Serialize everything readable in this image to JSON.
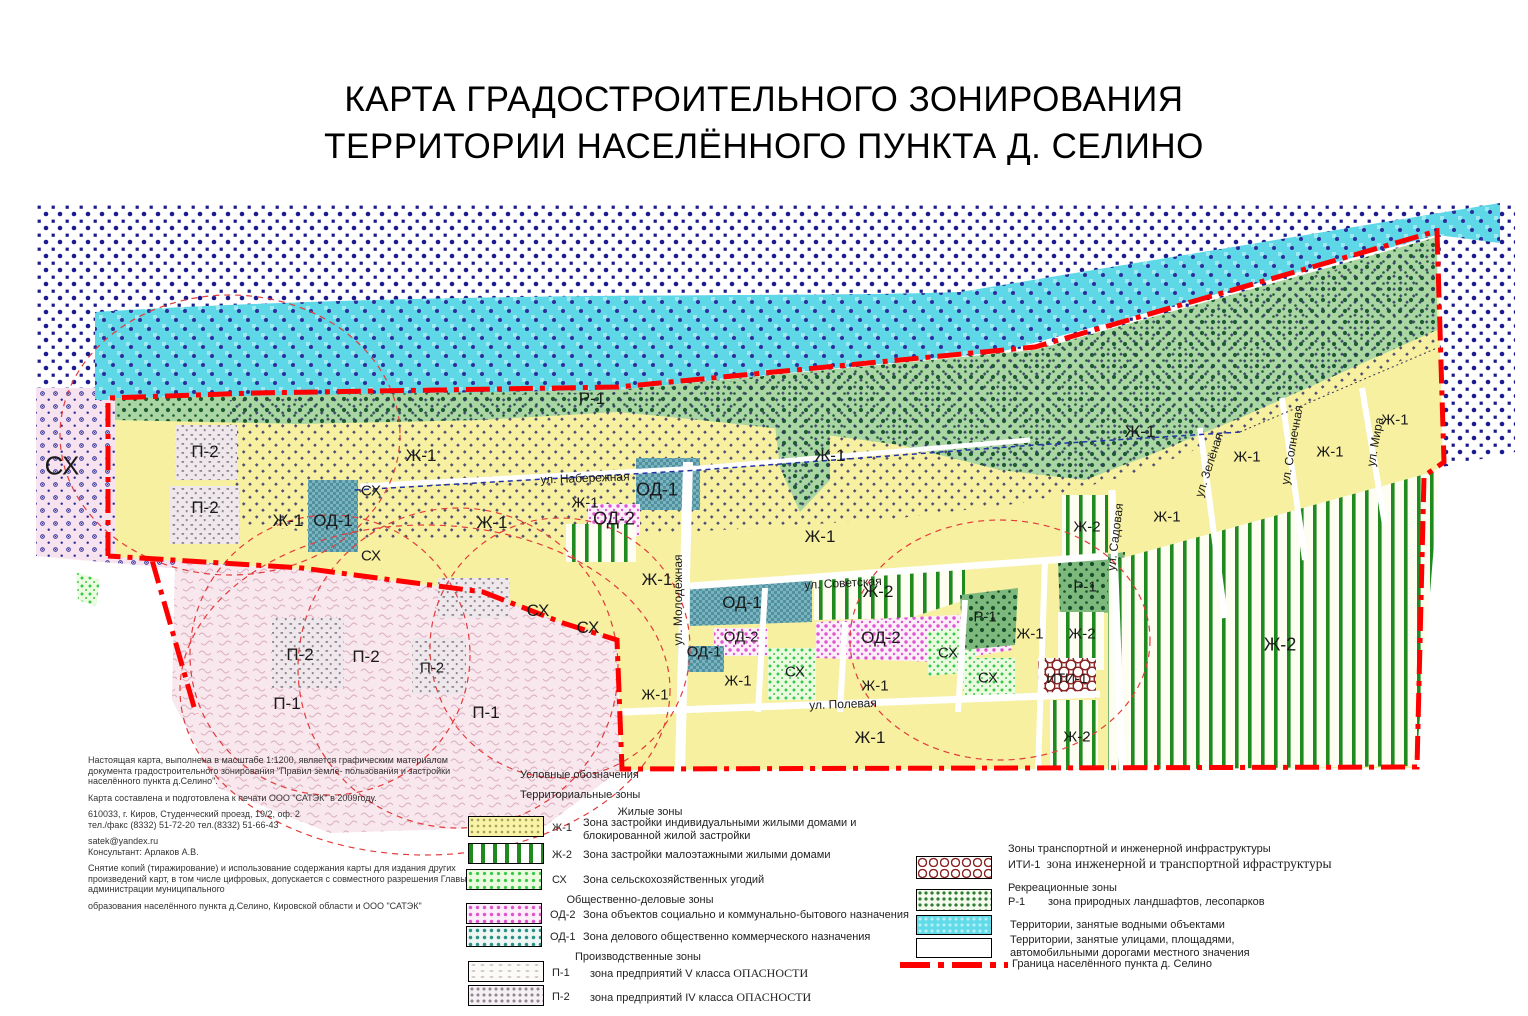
{
  "title": {
    "line1": "КАРТА ГРАДОСТРОИТЕЛЬНОГО ЗОНИРОВАНИЯ",
    "line2": "ТЕРРИТОРИИ НАСЕЛЁННОГО ПУНКТА Д. СЕЛИНО"
  },
  "colors": {
    "boundary_red": "#ff0000",
    "water_cyan": "#5ed7e7",
    "zh1_yellow": "#f6f0a0",
    "zh2_green_stripe": "#1f8b1f",
    "sx_green": "#3cc94a",
    "od1_teal": "#4f919f",
    "od2_magenta": "#de55cb",
    "r1_green": "#1d5c33",
    "iti_darkred": "#8b2222",
    "outside_navy": "#1b1b8f"
  },
  "map": {
    "zone_labels": [
      {
        "t": "СХ"
      },
      {
        "t": "П-2"
      },
      {
        "t": "П-2"
      },
      {
        "t": "Ж-1"
      },
      {
        "t": "ОД-1"
      },
      {
        "t": "СХ"
      },
      {
        "t": "СХ"
      },
      {
        "t": "Ж-1"
      },
      {
        "t": "Ж-1"
      },
      {
        "t": "Р-1"
      },
      {
        "t": "Ж-1"
      },
      {
        "t": "ОД-1"
      },
      {
        "t": "ОД-2"
      },
      {
        "t": "Ж-1"
      },
      {
        "t": "СХ"
      },
      {
        "t": "СХ"
      },
      {
        "t": "Ж-1"
      },
      {
        "t": "Ж-1"
      },
      {
        "t": "ОД-1"
      },
      {
        "t": "Ж-2"
      },
      {
        "t": "ОД-2"
      },
      {
        "t": "ОД-1"
      },
      {
        "t": "Ж-1"
      },
      {
        "t": "СХ"
      },
      {
        "t": "Ж-1"
      },
      {
        "t": "ОД-2"
      },
      {
        "t": "СХ"
      },
      {
        "t": "Р-1"
      },
      {
        "t": "СХ"
      },
      {
        "t": "Ж-1"
      },
      {
        "t": "Ж-2"
      },
      {
        "t": "ИТИ-1"
      },
      {
        "t": "Ж-2"
      },
      {
        "t": "Р-1"
      },
      {
        "t": "Ж-1"
      },
      {
        "t": "Ж-2"
      },
      {
        "t": "Ж-1"
      },
      {
        "t": "П-2"
      },
      {
        "t": "П-2"
      },
      {
        "t": "П-2"
      },
      {
        "t": "П-1"
      },
      {
        "t": "П-1"
      },
      {
        "t": "Ж-1"
      },
      {
        "t": "Ж-1"
      },
      {
        "t": "Ж-1"
      },
      {
        "t": "Ж-1"
      },
      {
        "t": "Ж-1"
      },
      {
        "t": "Ж-2"
      }
    ],
    "street_labels": [
      {
        "t": "ул. Набережная"
      },
      {
        "t": "ул. Молодёжная"
      },
      {
        "t": "ул. Советская"
      },
      {
        "t": "ул. Полевая"
      },
      {
        "t": "ул. Садовая"
      },
      {
        "t": "ул. Зелёная"
      },
      {
        "t": "ул. Солнечная"
      },
      {
        "t": "ул. Мира"
      }
    ]
  },
  "info_block": {
    "p1": "Настоящая карта, выполнена в масштабе 1:1200, является графическим материалом документа градостроительного зонирования \"Правил земле- пользования и застройки населённого пункта д.Селино\".",
    "p2": "Карта составлена и подготовлена к печати ООО \"САТЭК\" в 2009году.",
    "p3a": "610033, г. Киров, Студенческий проезд, 19/2, оф. 2",
    "p3b": "тел./факс (8332) 51-72-20 тел.(8332) 51-66-43",
    "p4a": "satek@yandex.ru",
    "p4b": "Консультант: Арлаков А.В.",
    "p5": "Снятие копий (тиражирование) и использование содержания карты для издания других произведений карт, в том числе цифровых, допускается с совместного разрешения Главы администрации муниципального",
    "p6": "образования населённого пункта д.Селино, Кировской области и ООО \"САТЭК\""
  },
  "legend": {
    "title": "Условные обозначения",
    "subtitle": "Территориальные зоны",
    "residential": {
      "header": "Жилые зоны",
      "zh1_code": "Ж-1",
      "zh1_desc": "Зона застройки индивидуальными жилыми домами и блокированной жилой застройки",
      "zh2_code": "Ж-2",
      "zh2_desc": "Зона застройки малоэтажными жилыми домами",
      "sx_code": "СХ",
      "sx_desc": "Зона сельскохозяйственных угодий"
    },
    "business": {
      "header": "Общественно-деловые зоны",
      "od2_code": "ОД-2",
      "od2_desc": "Зона  объектов социально и коммунально-бытового назначения",
      "od1_code": "ОД-1",
      "od1_desc": "Зона делового общественно коммерческого назначения"
    },
    "industrial": {
      "header": "Производственные зоны",
      "p1_code": "П-1",
      "p1_desc": "зона предприятий V класса",
      "p1_danger": "ОПАСНОСТИ",
      "p2_code": "П-2",
      "p2_desc": "зона предприятий IV класса",
      "p2_danger": "ОПАСНОСТИ"
    },
    "transport": {
      "header": "Зоны транспортной и инженерной инфраструктуры",
      "code": "ИТИ-1",
      "desc": "зона инженерной и транспортной ифраструктуры"
    },
    "recreation": {
      "header": "Рекреационные зоны",
      "code": "Р-1",
      "desc": "зона природных ландшафтов, лесопарков"
    },
    "water_desc": "Территории, занятые водными объектами",
    "streets_desc": "Территории, занятые улицами, площадями, автомобильными дорогами местного значения",
    "boundary_desc": "Граница населённого пункта д. Селино"
  }
}
